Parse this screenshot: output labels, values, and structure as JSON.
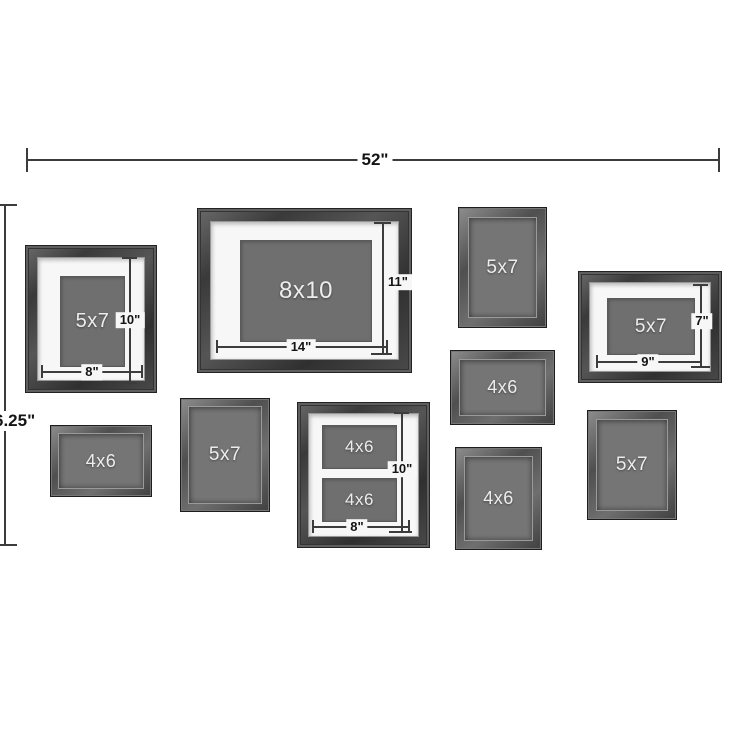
{
  "palette": {
    "background": "#ffffff",
    "frame_dark": "#3f3f3f",
    "mat_white": "#f7f7f7",
    "photo_gray": "#6f6f6f",
    "dimension_line": "#3c3c3c",
    "photo_label_text": "#ededed",
    "dimension_text": "#141414"
  },
  "overall": {
    "width_label": "52\"",
    "height_label": "6.25\""
  },
  "frames": [
    {
      "name": "matted-5x7-portrait-top-left",
      "label": "5x7",
      "width_dim": "8\"",
      "height_dim": "10\""
    },
    {
      "name": "matted-8x10-landscape-center",
      "label": "8x10",
      "width_dim": "14\"",
      "height_dim": "11\""
    },
    {
      "name": "simple-5x7-portrait-top-right",
      "label": "5x7"
    },
    {
      "name": "matted-5x7-landscape-right",
      "label": "5x7",
      "width_dim": "9\"",
      "height_dim": "7\""
    },
    {
      "name": "simple-4x6-landscape-middle",
      "label": "4x6"
    },
    {
      "name": "simple-4x6-landscape-bottom-left",
      "label": "4x6"
    },
    {
      "name": "simple-5x7-portrait-bottom-center-left",
      "label": "5x7"
    },
    {
      "name": "collage-double-4x6",
      "openings": [
        "4x6",
        "4x6"
      ],
      "width_dim": "8\"",
      "height_dim": "10\""
    },
    {
      "name": "simple-4x6-portrait-bottom-center-right",
      "label": "4x6"
    },
    {
      "name": "simple-5x7-portrait-bottom-right",
      "label": "5x7"
    }
  ]
}
